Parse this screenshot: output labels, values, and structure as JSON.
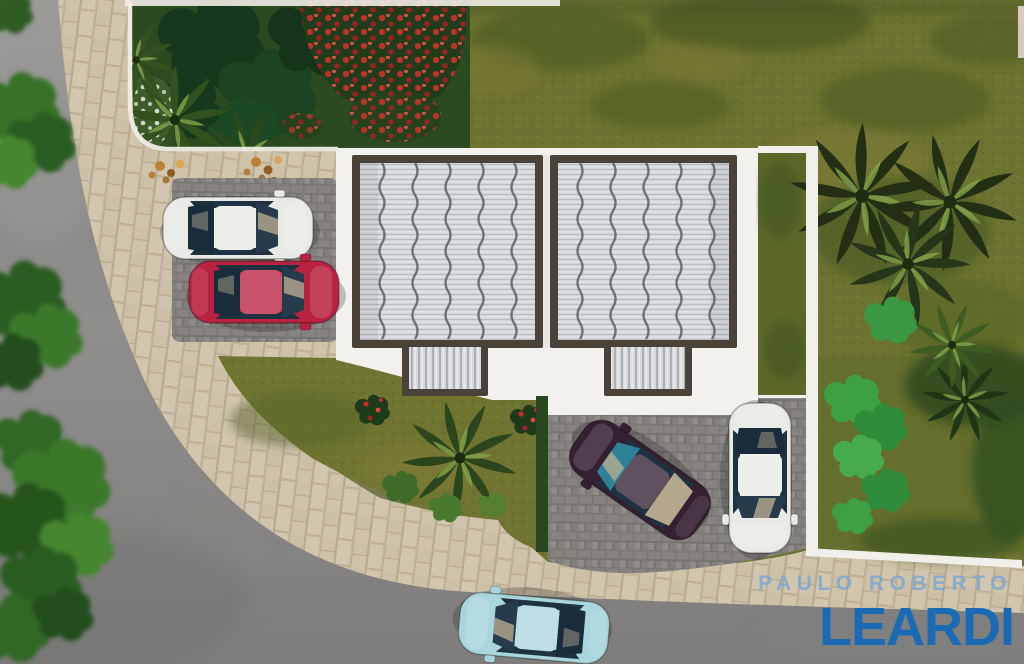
{
  "watermark": {
    "line1": "PAULO ROBERTO",
    "line2": "LEARDI"
  },
  "colors": {
    "logo_light_blue": "#7fa8d2",
    "logo_blue": "#1a6ab5",
    "lawn": "#6d7330",
    "street": "#8f8e8c",
    "sidewalk": "#d0c3ab",
    "paver_dark": "#8b8886",
    "roof": "#d2d5d9",
    "roof_frame": "#4a4138",
    "apron_white": "#f3f1ed",
    "hedge": "#2a4522",
    "grass_triangle": "#6f7530",
    "car_white": "#e9eae6",
    "car_red": "#b92240",
    "car_dark": "#342031",
    "car_blue": "#a9d5dd",
    "glass_teal": "#2f8198",
    "glass_beige": "#b3a78c",
    "flower_red": "#cc2a28"
  },
  "scene": {
    "description": "Aerial top-down 3D architectural rendering of two twin houses with corrugated metal roofs, landscaped front garden with red flowers, palm trees, paver driveways, five cars and a curved street",
    "setting": "real-estate listing rendering",
    "objects": [
      "curved-street",
      "paver-sidewalk",
      "front-garden-red-flowers",
      "white-perimeter-wall",
      "twin-house-roof-left",
      "twin-house-roof-right",
      "entrance-canopy-left",
      "entrance-canopy-right",
      "dark-paver-driveway",
      "parking-pad",
      "grass-triangle",
      "side-lawn-palms",
      "backyard-shrubs",
      "white-sedan-parked",
      "red-sedan-parked",
      "dark-sedan-parked",
      "white-sedan-vertical",
      "light-blue-sedan-street",
      "street-trees"
    ]
  }
}
